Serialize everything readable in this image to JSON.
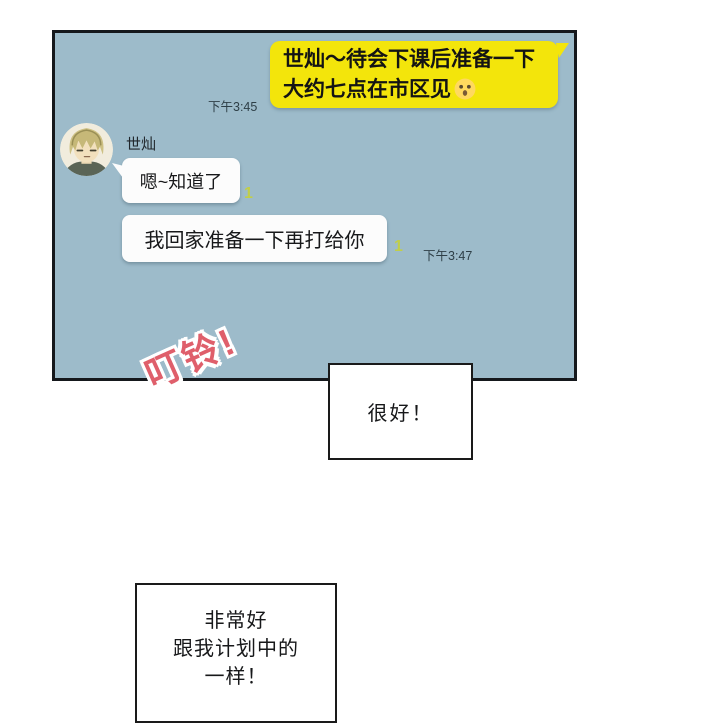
{
  "comic": {
    "chat_panel": {
      "sent_message": {
        "line1": "世灿～待会下课后准备一下",
        "line2": "大约七点在市区见",
        "emoji": "😯",
        "timestamp": "下午3:45"
      },
      "contact": {
        "name": "世灿"
      },
      "received_messages": [
        {
          "text": "嗯~知道了",
          "unread": "1"
        },
        {
          "text": "我回家准备一下再打给你",
          "unread": "1"
        }
      ],
      "received_timestamp": "下午3:47"
    },
    "sfx": {
      "text": "叮铃!"
    },
    "speech_boxes": [
      {
        "text": "很好！"
      },
      {
        "line1": "非常好",
        "line2": "跟我计划中的",
        "line3": "一样！"
      }
    ],
    "colors": {
      "panel_background": "#9dbbca",
      "panel_border": "#15181c",
      "sent_bubble": "#f3e50b",
      "received_bubble": "#fcfcfc",
      "unread_badge": "#c1ce49",
      "timestamp_text": "#2e3f47",
      "sfx_text": "#df5f6b"
    }
  }
}
